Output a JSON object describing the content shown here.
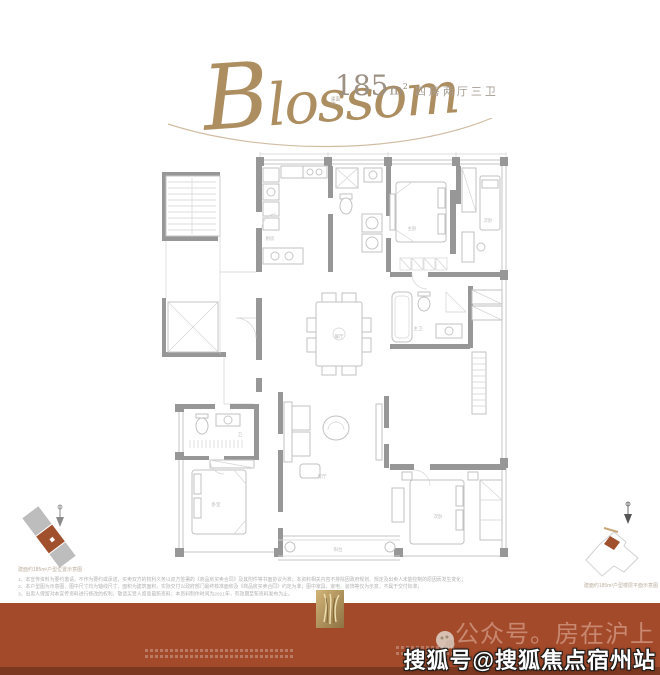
{
  "header": {
    "script_initial": "B",
    "script_rest": "lossom",
    "script_color": "#ac8e61",
    "area_prefix_1": "建面",
    "area_prefix_2": "约",
    "area_number": "185",
    "area_unit_base": "m",
    "area_unit_sup": "2",
    "layout_text": "四房两厅三卫"
  },
  "floorplan": {
    "wall_color": "#979797",
    "furniture_color": "#c2c2c2",
    "labels": {
      "kitchen": "厨房",
      "master": "主卧",
      "bedroom_tr": "次卧",
      "dining": "餐厅",
      "living": "客厅",
      "master_bath": "主卫",
      "bath2": "卫",
      "bedroom_bl": "卧室",
      "bedroom_br": "次卧",
      "balcony": "阳台"
    }
  },
  "left_diagram": {
    "caption": "建面约185m²户型位置示意图",
    "highlight_color": "#a1502e",
    "gray_color": "#bdbdbd"
  },
  "right_diagram": {
    "caption": "建面约185m²户型楼层平面示意图",
    "highlight_color": "#a1502e"
  },
  "disclaimer": {
    "line1": "1、本宣传资料为要约邀请，不作为要约或承诺，买卖双方的权利义务以双方签署的《商品房买卖合同》及其附件等书面协议为准；本资料相关内容不排除因政府规划、规定及出卖人未能控制的原因而发生变化；",
    "line2": "2、本户型图为示意图，图中尺寸均为轴线尺寸，面积为建筑面积，实际交付以政府部门最终核准面积及《商品房买卖合同》约定为准；图中家具、家电、装饰等仅为示意，不属于交付标准；",
    "line3": "3、出卖人保留对本宣传资料进行修改的权利，敬请买受人留意最新资料；本资料制作时间为2021年，有效期至新资料发布为止。"
  },
  "footer": {
    "band_color": "#a34a2b",
    "band_edge_color": "#7c3820",
    "account_text": "公众号。房在沪上",
    "watermark_text": "搜狐号@搜狐焦点宿州站"
  }
}
